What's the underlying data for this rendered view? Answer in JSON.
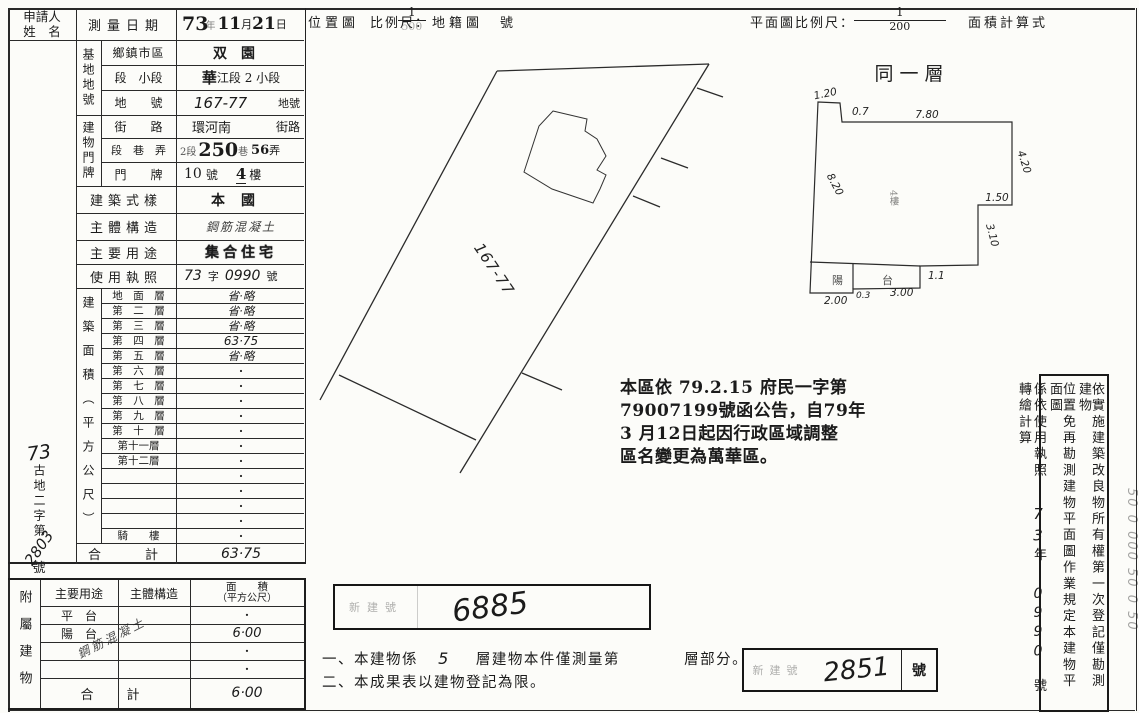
{
  "header": {
    "applicant_line1": "申請人",
    "applicant_line2": "姓　名",
    "survey_date_label": "測量日期",
    "date_year": "73",
    "date_year_unit": "年",
    "date_month": "11",
    "date_month_unit": "月",
    "date_day": "21",
    "date_day_unit": "日",
    "location_map_label": "位置圖",
    "location_scale_label": "比例尺：",
    "location_scale_numerator": "1",
    "location_scale_denominator": "500",
    "cadastral_map_label": "地籍圖",
    "cadastral_no_suffix": "號",
    "plan_scale_label": "平面圖比例尺：",
    "plan_scale_numerator": "1",
    "plan_scale_denominator": "200",
    "area_formula_label": "面積計算式"
  },
  "site_block": {
    "group_label": "基地地號",
    "district_label": "鄉鎮市區",
    "district_value": "双園",
    "section_label": "段　小段",
    "section_value_stamp": "華",
    "section_value": "江段 2 小段",
    "parcel_label": "地　　號",
    "parcel_value": "167-77",
    "parcel_suffix": "地號"
  },
  "door_block": {
    "group_label": "建物門牌",
    "street_label": "街　　路",
    "street_value": "環河南",
    "street_suffix": "街路",
    "lane_label": "段　巷　弄",
    "lane_section": "2段",
    "lane_value": "250",
    "lane_suffix": "巷",
    "alley_value": "56",
    "alley_suffix": "弄",
    "number_label": "門　　牌",
    "number_value": "10",
    "number_suffix": "號",
    "floor_value": "4",
    "floor_suffix": "樓"
  },
  "info_rows": {
    "style_label": "建築式樣",
    "style_value": "本國",
    "structure_label": "主體構造",
    "structure_value": "鋼筋混凝土",
    "usage_label": "主要用途",
    "usage_value": "集合住宅",
    "license_label": "使用執照",
    "license_year": "73",
    "license_zi": "字",
    "license_number": "0990",
    "license_suffix": "號"
  },
  "floors": {
    "group_label": "建築面積（平方公尺）",
    "rows": [
      {
        "label": "地　面　層",
        "value": "省·略"
      },
      {
        "label": "第　二　層",
        "value": "省·略"
      },
      {
        "label": "第　三　層",
        "value": "省·略"
      },
      {
        "label": "第　四　層",
        "value": "63·75"
      },
      {
        "label": "第　五　層",
        "value": "省·略"
      },
      {
        "label": "第　六　層",
        "value": "·"
      },
      {
        "label": "第　七　層",
        "value": "·"
      },
      {
        "label": "第　八　層",
        "value": "·"
      },
      {
        "label": "第　九　層",
        "value": "·"
      },
      {
        "label": "第　十　層",
        "value": "·"
      },
      {
        "label": "第十一層",
        "value": "·"
      },
      {
        "label": "第十二層",
        "value": "·"
      },
      {
        "label": "",
        "value": "·"
      },
      {
        "label": "",
        "value": "·"
      },
      {
        "label": "",
        "value": "·"
      },
      {
        "label": "",
        "value": "·"
      },
      {
        "label": "騎　　樓",
        "value": "·"
      }
    ],
    "total_label": "合　　計",
    "total_value": "63·75"
  },
  "ref_stamp": {
    "year": "73",
    "label": "古地二字第",
    "number": "2803",
    "suffix": "號"
  },
  "attached": {
    "group_label": "附屬建物",
    "use_header": "主要用途",
    "structure_header": "主體構造",
    "area_header_line1": "面　　積",
    "area_header_line2": "（平方公尺）",
    "rows": [
      {
        "use": "平　台",
        "area": "·"
      },
      {
        "use": "陽　台",
        "area": "6·00"
      },
      {
        "use": "",
        "area": "·"
      },
      {
        "use": "",
        "area": "·"
      }
    ],
    "diagonal_note": "鋼筋混凝土",
    "total_label": "合　計",
    "total_value": "6·00"
  },
  "announcement": {
    "line1": "本區依 79.2.15 府民一字第",
    "line2": "79007199號函公告，自79年",
    "line3": "3 月12日起因行政區域調整",
    "line4": "區名變更為萬華區。"
  },
  "building_no_stamp": {
    "label": "新建號",
    "value": "6885"
  },
  "notes": {
    "line1_pre": "一、本建物係",
    "line1_floors": "5",
    "line1_mid": "層建物本件僅測量第",
    "line1_end": "層部分。",
    "line2": "二、本成果表以建物登記為限。"
  },
  "receipt_box": {
    "label": "新建號",
    "value": "2851",
    "suffix": "號"
  },
  "right_note": {
    "col1": "依實施建築改良物所有權第一次登記僅勘測建物",
    "col2": "位置免再勘測建物平面圖作業規定本建物平面圖",
    "col3_pre": "係依使用執照",
    "col3_year": "73",
    "col3_year_unit": "年",
    "col3_number": "0990",
    "col3_post": "號轉繪計算"
  },
  "edge_marks": "50 0 000 50 0 50",
  "site_plan": {
    "parcel_label": "167-77"
  },
  "floor_plan": {
    "title": "同一層",
    "center_label": "4樓",
    "balcony_label": "陽　台",
    "dims": {
      "notch_w": "1.20",
      "notch_d": "0.7",
      "top": "7.80",
      "right_upper": "4.20",
      "step": "1.50",
      "right_lower": "3.10",
      "left": "8.20",
      "bottom_left": "2.00",
      "bottom_mid": "0.3",
      "balcony_w": "3.00",
      "balcony_d": "1.1"
    }
  }
}
